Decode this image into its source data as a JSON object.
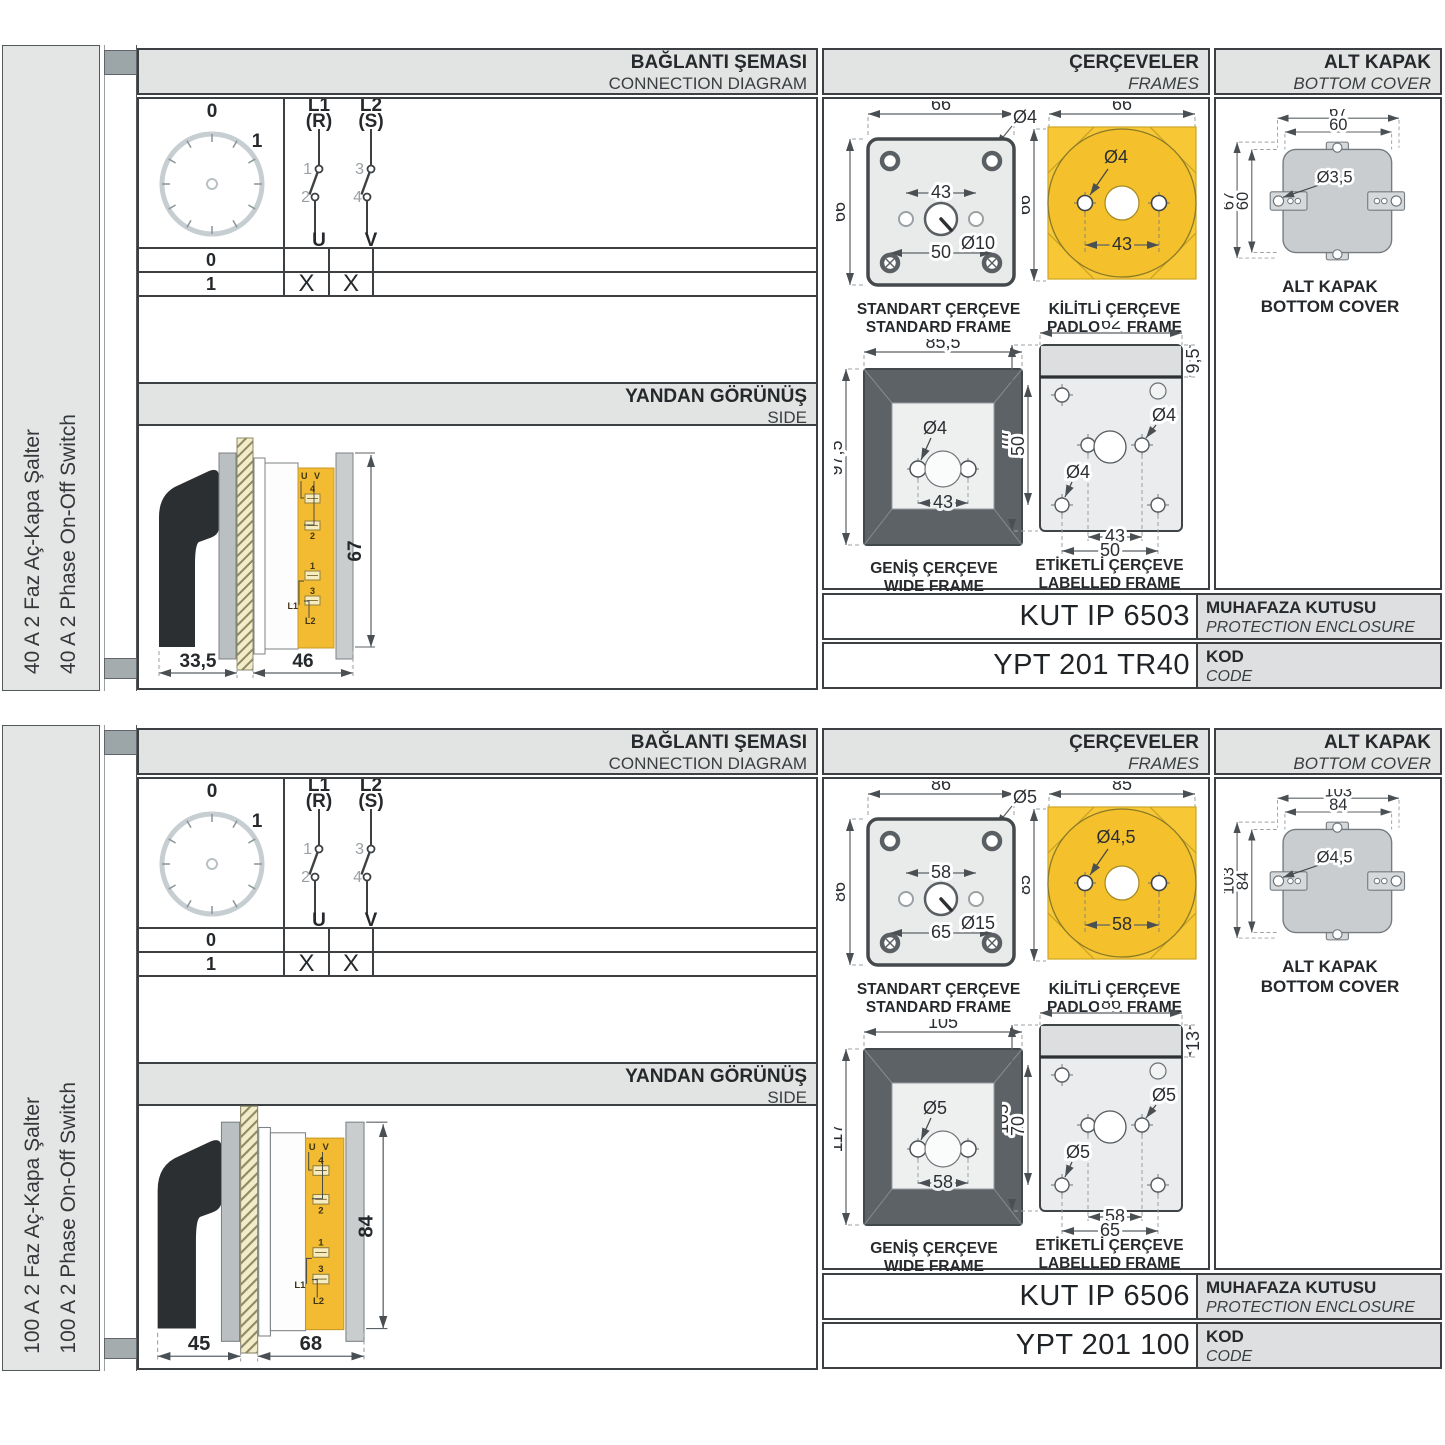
{
  "headers": {
    "connection": {
      "tr": "BAĞLANTI ŞEMASI",
      "en": "CONNECTION DIAGRAM"
    },
    "frames": {
      "tr": "ÇERÇEVELER",
      "en": "FRAMES"
    },
    "cover": {
      "tr": "ALT KAPAK",
      "en": "BOTTOM COVER"
    },
    "side": {
      "tr": "YANDAN GÖRÜNÜŞ",
      "en": "SIDE"
    },
    "enclosure": {
      "tr": "MUHAFAZA KUTUSU",
      "en": "PROTECTION ENCLOSURE"
    },
    "code": {
      "tr": "KOD",
      "en": "CODE"
    }
  },
  "colors": {
    "accent_yellow": "#f7c735",
    "header_gray": "#e2e3e3",
    "line_dark": "#3f4447"
  },
  "sections": [
    {
      "product": {
        "tr": "40 A 2 Faz Aç-Kapa Şalter",
        "en": "40 A 2 Phase On-Off Switch"
      },
      "dial": {
        "pos0": "0",
        "pos1": "1"
      },
      "poles": {
        "p1": {
          "line": "L1",
          "phase": "(R)",
          "top": "1",
          "bottom": "2",
          "out": "U"
        },
        "p2": {
          "line": "L2",
          "phase": "(S)",
          "top": "3",
          "bottom": "4",
          "out": "V"
        }
      },
      "state_table": {
        "rows": [
          {
            "pos": "0",
            "u": "",
            "v": ""
          },
          {
            "pos": "1",
            "u": "X",
            "v": "X"
          }
        ]
      },
      "side_view": {
        "h": "67",
        "d1": "33,5",
        "d2": "46",
        "terminals": {
          "u": "U",
          "v": "V",
          "t4": "4",
          "t2": "2",
          "t1": "1",
          "t3": "3",
          "l1": "L1",
          "l2": "L2"
        }
      },
      "standard_frame": {
        "title_tr": "STANDART ÇERÇEVE",
        "title_en": "STANDARD FRAME",
        "w": "66",
        "h": "66",
        "hole": "Ø4",
        "inner": "43",
        "center": "Ø10",
        "outer": "50"
      },
      "padlock_frame": {
        "title_tr": "KİLİTLİ ÇERÇEVE",
        "title_en": "PADLOCK FRAME",
        "w": "66",
        "h": "66",
        "hole": "Ø4",
        "inner": "43"
      },
      "wide_frame": {
        "title_tr": "GENİŞ ÇERÇEVE",
        "title_en": "WIDE FRAME",
        "w": "85,5",
        "h": "97,5",
        "hole": "Ø4",
        "inner": "43"
      },
      "labelled_frame": {
        "title_tr": "ETİKETLİ ÇERÇEVE",
        "title_en": "LABELLED FRAME",
        "w": "62",
        "strip": "9,5",
        "h": "77",
        "inner_h": "50",
        "hole_right": "Ø4",
        "hole_left": "Ø4",
        "inner": "43",
        "outer": "50"
      },
      "bottom_cover": {
        "title_tr": "ALT KAPAK",
        "title_en": "BOTTOM COVER",
        "w_out": "67",
        "w_in": "60",
        "h_out": "67",
        "h_in": "60",
        "hole": "Ø3,5"
      },
      "enclosure_code": "KUT IP 6503",
      "product_code": "YPT 201 TR40"
    },
    {
      "product": {
        "tr": "100 A 2 Faz Aç-Kapa Şalter",
        "en": "100 A 2 Phase On-Off Switch"
      },
      "dial": {
        "pos0": "0",
        "pos1": "1"
      },
      "poles": {
        "p1": {
          "line": "L1",
          "phase": "(R)",
          "top": "1",
          "bottom": "2",
          "out": "U"
        },
        "p2": {
          "line": "L2",
          "phase": "(S)",
          "top": "3",
          "bottom": "4",
          "out": "V"
        }
      },
      "state_table": {
        "rows": [
          {
            "pos": "0",
            "u": "",
            "v": ""
          },
          {
            "pos": "1",
            "u": "X",
            "v": "X"
          }
        ]
      },
      "side_view": {
        "h": "84",
        "d1": "45",
        "d2": "68",
        "terminals": {
          "u": "U",
          "v": "V",
          "t4": "4",
          "t2": "2",
          "t1": "1",
          "t3": "3",
          "l1": "L1",
          "l2": "L2"
        }
      },
      "standard_frame": {
        "title_tr": "STANDART ÇERÇEVE",
        "title_en": "STANDARD FRAME",
        "w": "86",
        "h": "86",
        "hole": "Ø5",
        "inner": "58",
        "center": "Ø15",
        "outer": "65"
      },
      "padlock_frame": {
        "title_tr": "KİLİTLİ ÇERÇEVE",
        "title_en": "PADLOCK FRAME",
        "w": "85",
        "h": "85",
        "hole": "Ø4,5",
        "inner": "58"
      },
      "wide_frame": {
        "title_tr": "GENİŞ ÇERÇEVE",
        "title_en": "WIDE FRAME",
        "w": "105",
        "h": "117",
        "hole": "Ø5",
        "inner": "58"
      },
      "labelled_frame": {
        "title_tr": "ETİKETLİ ÇERÇEVE",
        "title_en": "LABELLED FRAME",
        "w": "86",
        "strip": "13",
        "h": "105",
        "inner_h": "70",
        "hole_right": "Ø5",
        "hole_left": "Ø5",
        "inner": "58",
        "outer": "65"
      },
      "bottom_cover": {
        "title_tr": "ALT KAPAK",
        "title_en": "BOTTOM COVER",
        "w_out": "103",
        "w_in": "84",
        "h_out": "103",
        "h_in": "84",
        "hole": "Ø4,5"
      },
      "enclosure_code": "KUT IP 6506",
      "product_code": "YPT 201 100"
    }
  ]
}
